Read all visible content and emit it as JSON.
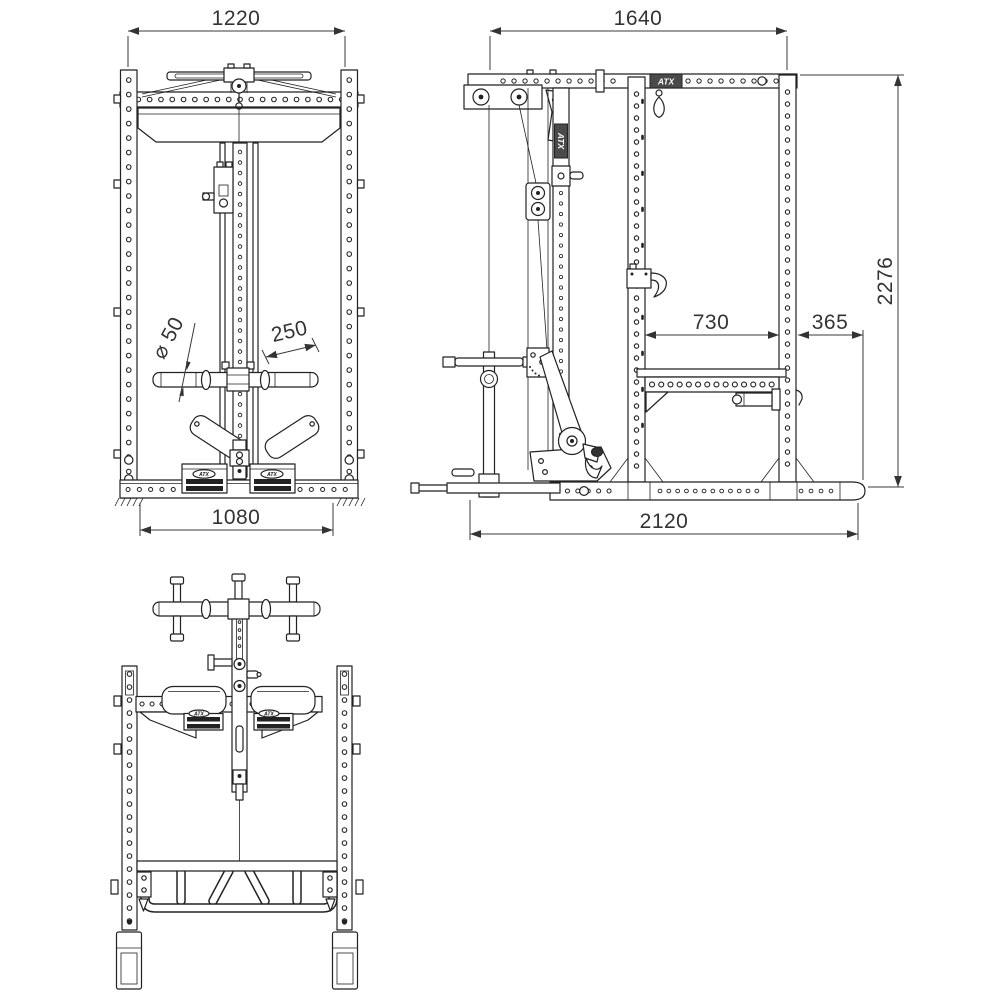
{
  "meta": {
    "type": "technical-drawing",
    "subject": "power rack with lat pulley, three orthographic views"
  },
  "brand": "ATX",
  "colors": {
    "line": "#222222",
    "dim": "#3a3a3a",
    "background": "#ffffff",
    "dark_fill": "#222222"
  },
  "views": {
    "front": {
      "label": "front-view",
      "dims": {
        "top_width": "1220",
        "bottom_width": "1080",
        "bar_diameter": "⌀ 50",
        "grip_length": "250"
      }
    },
    "side": {
      "label": "side-view",
      "dims": {
        "top_depth": "1640",
        "bottom_depth": "2120",
        "height": "2276",
        "inner_depth": "730",
        "rear_offset": "365"
      }
    },
    "top": {
      "label": "top-view",
      "dims": {}
    }
  }
}
